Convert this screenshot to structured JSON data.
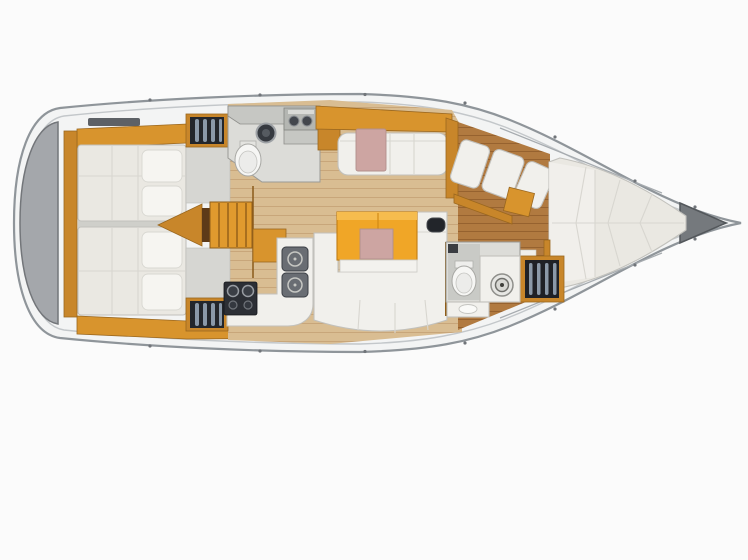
{
  "canvas": {
    "width": 748,
    "height": 560
  },
  "scene": {
    "kind": "sailboat-interior-floor-plan-overhead-view",
    "bow_direction": "right",
    "stern_direction": "left"
  },
  "palette": {
    "background": "#fbfbfb",
    "hull_deck": "#f3f4f4",
    "hull_edge": "#8f959a",
    "hull_inner_line": "#c3c7ca",
    "stern_platform": "#a4a7ab",
    "anchor_locker": "#75797d",
    "wood": "#d8942d",
    "wood_dark": "#c8862a",
    "wood_trim": "#9a671f",
    "table": "#f0a627",
    "floor_saloon": "#d9bd92",
    "floor_grain": "#c8a67a",
    "floor_forward": "#b17a40",
    "floor_forward_grain": "#96622f",
    "cushion": "#f1f0ec",
    "cushion_edge": "#c2c1bc",
    "mattress": "#eae8e2",
    "accent_pink": "#cda5a2",
    "dark_unit": "#2c2f35",
    "grey_counter": "#c6c7c3",
    "head_floor": "#dcdcd8",
    "stripe_light": "#8b99a8"
  },
  "components": [
    {
      "id": "hull",
      "kind": "hull-outline"
    },
    {
      "id": "stern-swim-platform",
      "kind": "grey-transom-cap"
    },
    {
      "id": "anchor-locker",
      "kind": "bow-triangle-locker"
    },
    {
      "id": "aft-cabin-upper-berth",
      "kind": "double-bed"
    },
    {
      "id": "aft-cabin-lower-berth",
      "kind": "double-bed"
    },
    {
      "id": "aft-cabin-upper-wardrobe",
      "kind": "hanging-locker"
    },
    {
      "id": "aft-cabin-lower-wardrobe",
      "kind": "hanging-locker"
    },
    {
      "id": "companionway-steps",
      "kind": "stairs"
    },
    {
      "id": "aft-head",
      "kind": "toilet-room"
    },
    {
      "id": "aft-head-toilet",
      "kind": "toilet"
    },
    {
      "id": "aft-head-basin",
      "kind": "round-sink"
    },
    {
      "id": "aft-head-counter-unit",
      "kind": "twin-basin-counter"
    },
    {
      "id": "upper-settee",
      "kind": "bench-seat"
    },
    {
      "id": "nav-panel",
      "kind": "pink-chart-seat-panel"
    },
    {
      "id": "galley-counter",
      "kind": "l-shaped-counter"
    },
    {
      "id": "galley-sink-1",
      "kind": "square-sink"
    },
    {
      "id": "galley-sink-2",
      "kind": "square-sink"
    },
    {
      "id": "galley-stove",
      "kind": "two-burner-stove"
    },
    {
      "id": "saloon-table",
      "kind": "dining-table-with-pink-inlay"
    },
    {
      "id": "saloon-u-settee",
      "kind": "u-shaped-sofa"
    },
    {
      "id": "saloon-tv-unit",
      "kind": "dark-wall-unit"
    },
    {
      "id": "forward-bulkhead",
      "kind": "wood-wall-with-door"
    },
    {
      "id": "forward-cabin-seat-cushions",
      "kind": "angled-cushions"
    },
    {
      "id": "forward-cabin-cabinet",
      "kind": "wood-cabinet"
    },
    {
      "id": "v-berth",
      "kind": "double-bed-tapered"
    },
    {
      "id": "forward-head",
      "kind": "toilet-room"
    },
    {
      "id": "forward-head-toilet",
      "kind": "toilet"
    },
    {
      "id": "forward-head-sink",
      "kind": "round-sink"
    },
    {
      "id": "forward-wardrobe",
      "kind": "shelved-locker"
    },
    {
      "id": "saloon-floor",
      "kind": "wood-plank-floor"
    },
    {
      "id": "forward-floor",
      "kind": "wood-plank-floor"
    }
  ]
}
